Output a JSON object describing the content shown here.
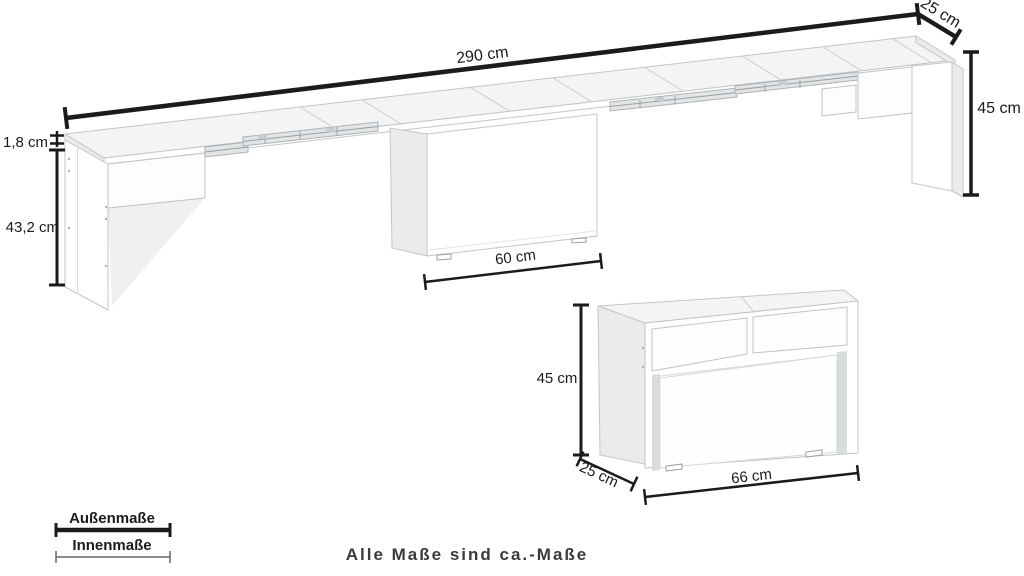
{
  "diagram": {
    "note": "Alle Maße sind ca.-Maße",
    "legend": {
      "outer_label": "Außenmaße",
      "inner_label": "Innenmaße"
    },
    "extended_bench": {
      "length_label": "290 cm",
      "depth_label": "25 cm",
      "height_label": "45 cm",
      "top_thickness_label": "1,8 cm",
      "inner_height_label": "43,2 cm",
      "pedestal_width_label": "60 cm"
    },
    "compact_bench": {
      "height_label": "45 cm",
      "depth_label": "25 cm",
      "width_label": "66 cm"
    },
    "colors": {
      "dimension_line": "#1b1b1b",
      "note_text": "#3b3b3b",
      "furniture_stroke": "#c2c5c7",
      "face_top": "#f3f4f5",
      "face_side": "#e9ebec",
      "face_front": "#ffffff"
    }
  }
}
